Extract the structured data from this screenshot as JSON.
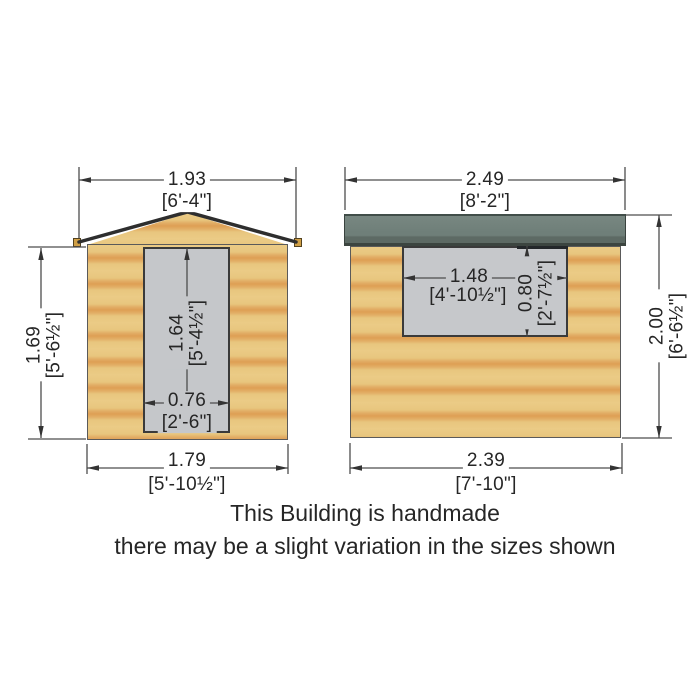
{
  "front": {
    "dims": {
      "roof_width": {
        "metric": "1.93",
        "imperial": "[6'-4\"]"
      },
      "wall_height": {
        "metric": "1.69",
        "imperial": "[5'-6½\"]"
      },
      "door_height": {
        "metric": "1.64",
        "imperial": "[5'-4½\"]"
      },
      "door_width": {
        "metric": "0.76",
        "imperial": "[2'-6\"]"
      },
      "base_width": {
        "metric": "1.79",
        "imperial": "[5'-10½\"]"
      }
    }
  },
  "side": {
    "dims": {
      "roof_width": {
        "metric": "2.49",
        "imperial": "[8'-2\"]"
      },
      "window_width": {
        "metric": "1.48",
        "imperial": "[4'-10½\"]"
      },
      "window_height": {
        "metric": "0.80",
        "imperial": "[2'-7½\"]"
      },
      "wall_height": {
        "metric": "2.00",
        "imperial": "[6'-6½\"]"
      },
      "base_width": {
        "metric": "2.39",
        "imperial": "[7'-10\"]"
      }
    }
  },
  "note": {
    "line1": "This Building is handmade",
    "line2": "there may be a slight variation in the sizes shown"
  },
  "colors": {
    "wood_light": "#ebcb86",
    "wood_dark": "#de9f54",
    "roof_felt": "#6f7f79",
    "joinery_grey": "#c6c8cb",
    "dimension_line": "#4d4d4d",
    "text": "#262626"
  }
}
